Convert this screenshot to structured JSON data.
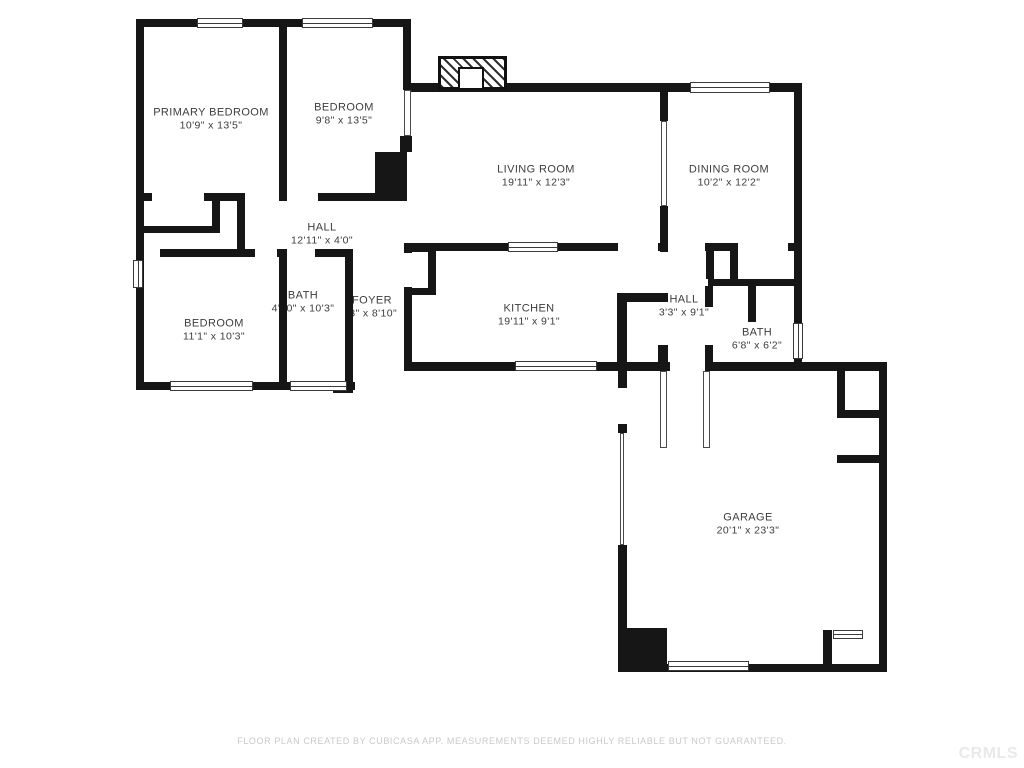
{
  "meta": {
    "background_color": "#ffffff",
    "wall_color": "#161616",
    "label_color": "#3d3d3d",
    "footer_color": "#c9c9c9",
    "watermark_color": "#e9e9e9"
  },
  "rooms": [
    {
      "name": "PRIMARY BEDROOM",
      "dims": "10'9\" x 13'5\""
    },
    {
      "name": "BEDROOM",
      "dims": "9'8\" x 13'5\""
    },
    {
      "name": "LIVING ROOM",
      "dims": "19'11\" x 12'3\""
    },
    {
      "name": "DINING ROOM",
      "dims": "10'2\" x 12'2\""
    },
    {
      "name": "HALL",
      "dims": "12'11\" x 4'0\""
    },
    {
      "name": "BATH",
      "dims": "4'10\" x 10'3\""
    },
    {
      "name": "FOYER",
      "dims": "'3\" x 8'10\""
    },
    {
      "name": "BEDROOM",
      "dims": "11'1\" x 10'3\""
    },
    {
      "name": "KITCHEN",
      "dims": "19'11\" x 9'1\""
    },
    {
      "name": "HALL",
      "dims": "3'3\" x 9'1\""
    },
    {
      "name": "BATH",
      "dims": "6'8\" x 6'2\""
    },
    {
      "name": "GARAGE",
      "dims": "20'1\" x 23'3\""
    }
  ],
  "footer": {
    "disclaimer": "FLOOR PLAN CREATED BY CUBICASA APP. MEASUREMENTS DEEMED HIGHLY RELIABLE BUT NOT GUARANTEED."
  },
  "watermark": "CRMLS"
}
